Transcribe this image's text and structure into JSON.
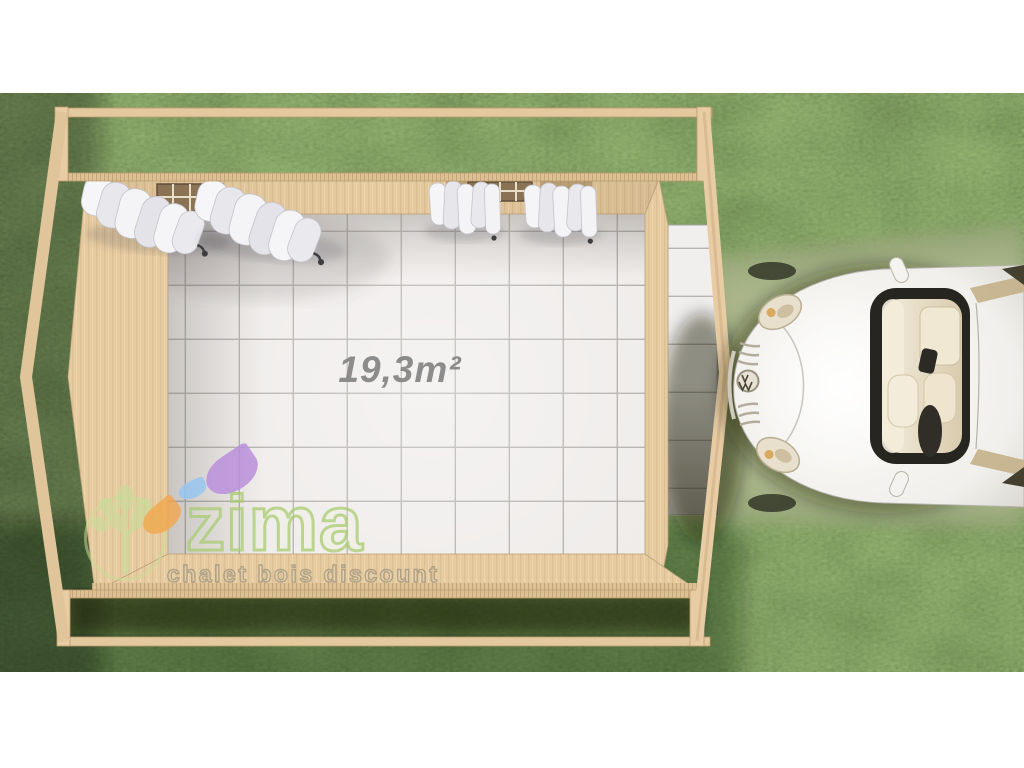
{
  "scene": {
    "type": "3d-top-view-render",
    "subject": "wooden garden shelter with tiled floor, pergola frame, curtains, exterior tile path and white convertible car on grass"
  },
  "floor": {
    "area_label": "19,3m²",
    "area_value": "19,3",
    "area_unit": "m²"
  },
  "watermark": {
    "brand": "zima",
    "tagline": "chalet bois discount"
  },
  "icons": {
    "logo_tree": "tree-logo-icon",
    "logo_leaves": [
      "orange-leaf-icon",
      "blue-leaf-icon",
      "purple-leaf-icon"
    ],
    "car_badge": "vw-badge-icon"
  },
  "colors": {
    "background_margin": "#ffffff",
    "grass_dark": "#3a4522",
    "grass_light_band": "#a7b287",
    "wood_beam": "#e5c99e",
    "wall_wood": "#e6cba0",
    "tile_floor": "#efecea",
    "tile_grout": "#b2afab",
    "area_label_gray": "#848484",
    "logo_green": "#a6ca6c",
    "leaf_orange": "#f2a64c",
    "leaf_blue": "#98c6ee",
    "leaf_purple": "#ba8fdc",
    "curtain_white": "#f5f5f7",
    "car_body_white": "#f2f1ed",
    "car_interior_beige": "#e9ddc2"
  }
}
